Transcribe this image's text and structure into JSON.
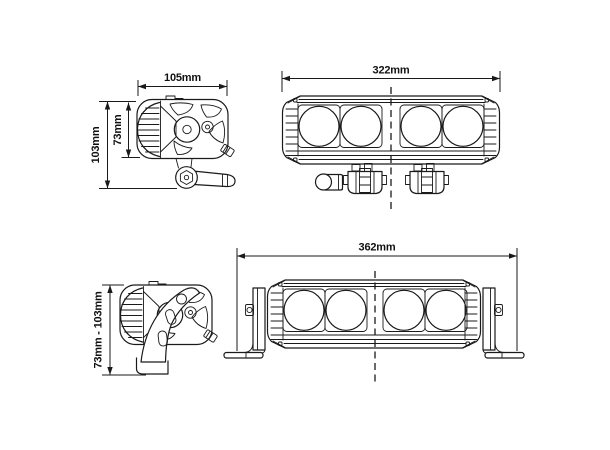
{
  "colors": {
    "background": "#ffffff",
    "line": "#1a1a1a"
  },
  "views": {
    "pod_side_top": {
      "width": "105mm",
      "overall_height": "103mm",
      "body_height": "73mm"
    },
    "bar_four_led": {
      "overall_width": "322mm"
    },
    "pod_side_bottom": {
      "height_range": "73mm - 103mm"
    },
    "bar_four_led_bracketed": {
      "overall_width": "362mm"
    }
  }
}
